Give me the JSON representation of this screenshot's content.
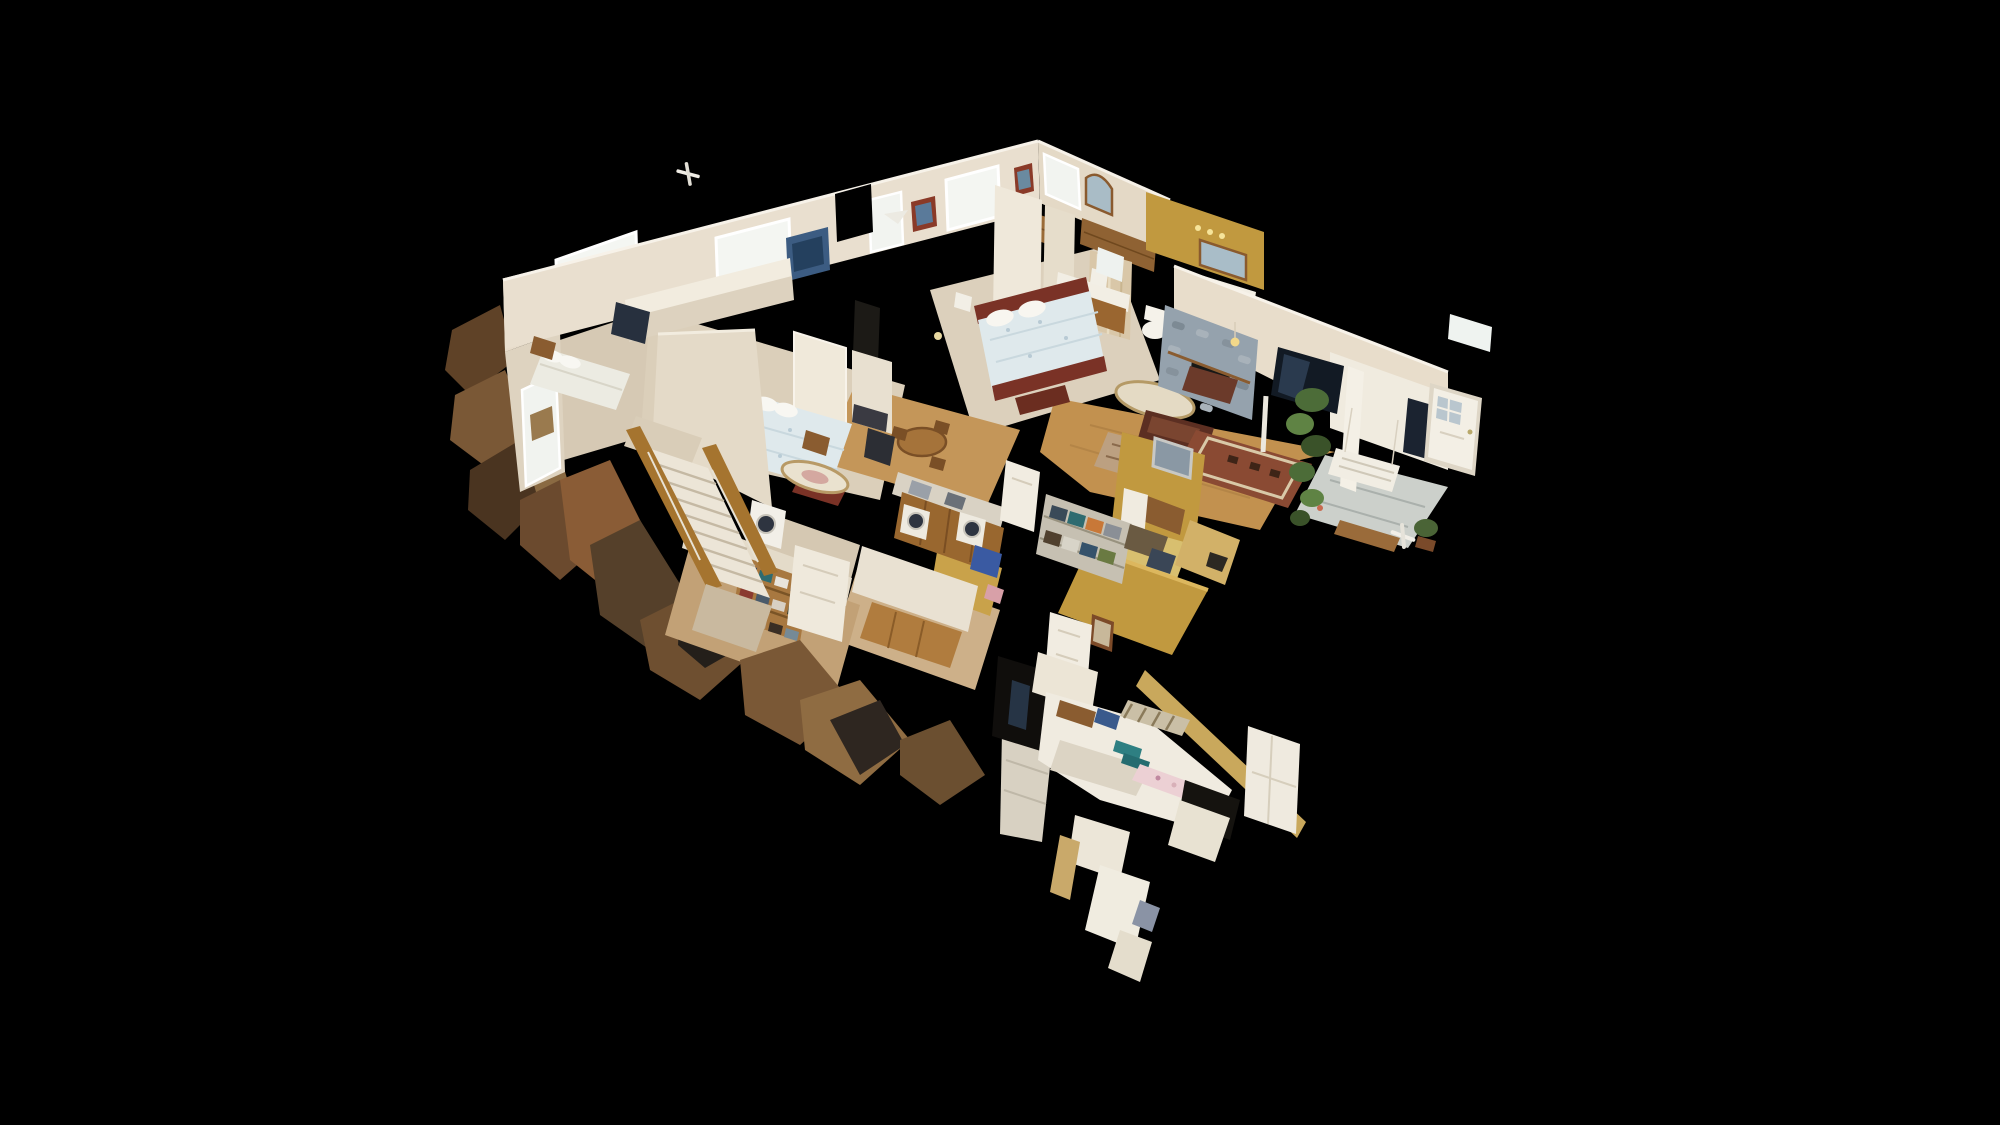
{
  "view": {
    "title": "3D dollhouse cutaway view of a scanned single-family home interior on a black background",
    "mode": "dollhouse"
  },
  "palette": {
    "background": "#000000",
    "wall": "#e9dfcf",
    "wallShaded": "#ded3c0",
    "wallBright": "#f2ecdf",
    "windowGlow": "#f4f6f2",
    "carpet": "#dbcfba",
    "hardwood": "#c2914f",
    "tile": "#ccd0cb",
    "goldWall": "#c1993f",
    "stone": "#95a2ad",
    "tvScreen": "#121a24",
    "bedQuilt": "#dfe9ec",
    "bedFrame": "#7a3226",
    "stairRail": "#a5742f",
    "towelTeal": "#2e7f82",
    "plantGreen": "#4c6c38",
    "woodFurniture": "#99672f",
    "debrisBrown": "#7a5836"
  },
  "rooms": [
    {
      "id": "left-bedroom"
    },
    {
      "id": "middle-bedroom"
    },
    {
      "id": "master-bedroom"
    },
    {
      "id": "bathroom"
    },
    {
      "id": "living-room"
    },
    {
      "id": "entry"
    },
    {
      "id": "kitchen"
    },
    {
      "id": "hallway"
    },
    {
      "id": "staircase"
    },
    {
      "id": "storage-closet"
    },
    {
      "id": "laundry-craft-wing"
    }
  ]
}
